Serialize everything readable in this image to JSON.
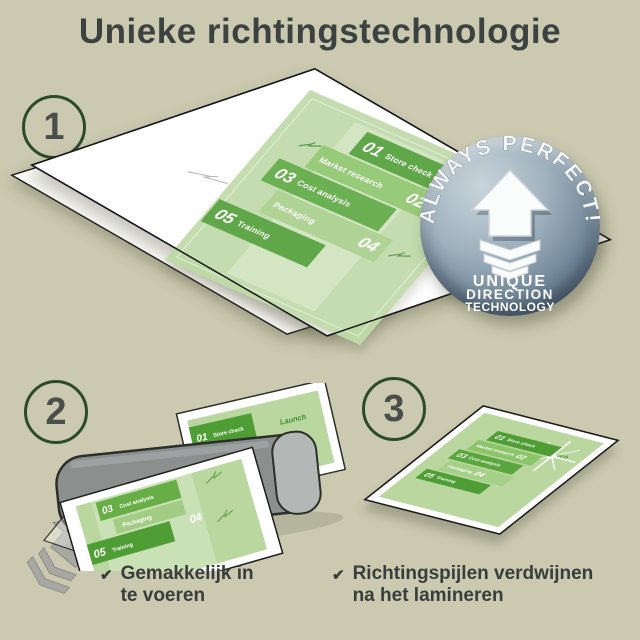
{
  "title": "Unieke richtingstechnologie",
  "steps": {
    "one": "1",
    "two": "2",
    "three": "3"
  },
  "badge": {
    "arc": "ALWAYS PERFECT!",
    "line1": "UNIQUE",
    "line2": "DIRECTION",
    "line3": "TECHNOLOGY"
  },
  "doc": {
    "launch": "Launch",
    "items": [
      {
        "num": "01",
        "label": "Store check"
      },
      {
        "num": "02",
        "label": "Market research"
      },
      {
        "num": "03",
        "label": "Cost analysis"
      },
      {
        "num": "04",
        "label": "Packaging"
      },
      {
        "num": "05",
        "label": "Training"
      }
    ]
  },
  "captions": {
    "check": "✔",
    "feed_line1": "Gemakkelijk in",
    "feed_line2": "te voeren",
    "arrows_line1": "Richtingspijlen verdwijnen",
    "arrows_line2": "na het lamineren"
  },
  "colors": {
    "background": "#cbcab1",
    "text": "#3c4240",
    "green_dark": "#4f9e35",
    "green_mid": "#8cc46a",
    "green_light": "#a6cf88",
    "doc_bg": "#bed9a6",
    "badge_steel": "#6e8496",
    "laminator_gray": "#8b908f"
  }
}
